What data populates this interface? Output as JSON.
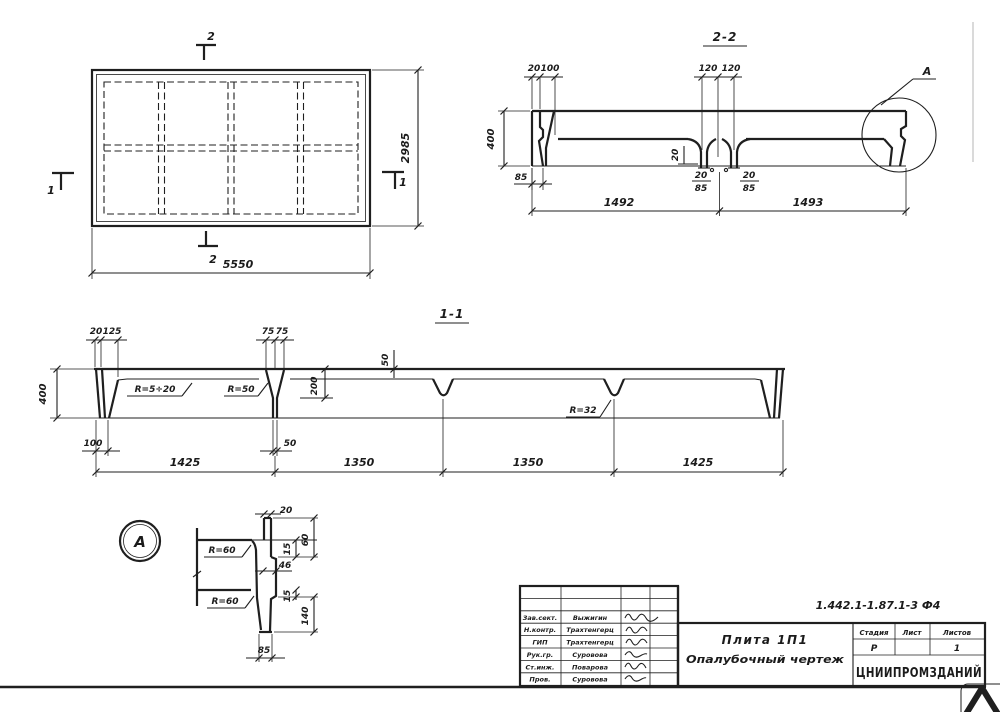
{
  "colors": {
    "ink": "#1f1f1f",
    "paper": "#ffffff",
    "frame_faint": "#b5b5b5",
    "watermark": "#c6c6c6"
  },
  "plan": {
    "section_mark_2": "2",
    "section_mark_1": "1",
    "dim_width": "5550",
    "dim_height": "2985"
  },
  "section22": {
    "title": "2-2",
    "detail_label": "А",
    "dim_20": "20",
    "dim_100": "100",
    "dim_120": "120",
    "dim_400": "400",
    "dim_85": "85",
    "dim_note_20": "20",
    "foot_20": "20",
    "foot_85": "85",
    "dim_1492": "1492",
    "dim_1493": "1493"
  },
  "section11": {
    "title": "1-1",
    "dim_20": "20",
    "dim_125": "125",
    "dim_75": "75",
    "dim_50_top": "50",
    "dim_200": "200",
    "dim_400": "400",
    "dim_100": "100",
    "dim_50": "50",
    "dim_1425": "1425",
    "dim_1350": "1350",
    "radius_1": "R=5÷20",
    "radius_2": "R=50",
    "radius_3": "R=32"
  },
  "detail_a": {
    "label": "А",
    "dim_20": "20",
    "dim_15": "15",
    "dim_60": "60",
    "dim_46": "46",
    "dim_140": "140",
    "dim_85": "85",
    "radius": "R=60"
  },
  "title_block": {
    "doc_code": "1.442.1-1.87.1-3 Ф4",
    "product_title": "Плита 1П1",
    "drawing_type": "Опалубочный чертеж",
    "organization": "ЦНИИПРОМЗДАНИЙ",
    "stage_label": "Стадия",
    "sheet_label": "Лист",
    "sheets_label": "Листов",
    "stage_value": "Р",
    "sheet_value": "",
    "sheets_value": "1",
    "signatures": [
      {
        "role": "Зав.сект.",
        "name": "Выжигин"
      },
      {
        "role": "Н.контр.",
        "name": "Трахтенгерц"
      },
      {
        "role": "ГИП",
        "name": "Трахтенгерц"
      },
      {
        "role": "Рук.гр.",
        "name": "Суровова"
      },
      {
        "role": "Ст.инж.",
        "name": "Поварова"
      },
      {
        "role": "Пров.",
        "name": "Суровова"
      }
    ]
  },
  "watermark": {
    "glyph": "Λ"
  }
}
